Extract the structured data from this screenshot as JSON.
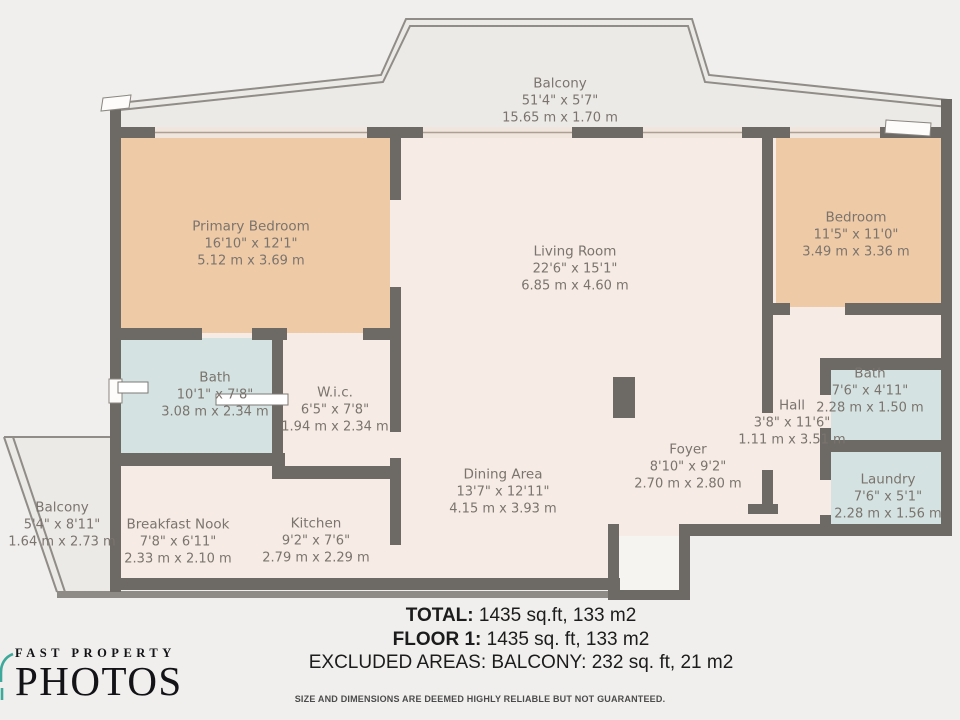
{
  "floorplan": {
    "rooms": [
      {
        "name": "Balcony",
        "imperial": "51'4\" x 5'7\"",
        "metric": "15.65 m x 1.70 m"
      },
      {
        "name": "Primary Bedroom",
        "imperial": "16'10\" x 12'1\"",
        "metric": "5.12 m x 3.69 m"
      },
      {
        "name": "Living Room",
        "imperial": "22'6\" x 15'1\"",
        "metric": "6.85 m x 4.60 m"
      },
      {
        "name": "Bedroom",
        "imperial": "11'5\" x 11'0\"",
        "metric": "3.49 m x 3.36 m"
      },
      {
        "name": "Bath",
        "imperial": "10'1\" x 7'8\"",
        "metric": "3.08 m x 2.34 m"
      },
      {
        "name": "W.i.c.",
        "imperial": "6'5\" x 7'8\"",
        "metric": "1.94 m x 2.34 m"
      },
      {
        "name": "Hall",
        "imperial": "3'8\" x 11'6\"",
        "metric": "1.11 m x 3.51 m"
      },
      {
        "name": "Bath",
        "imperial": "7'6\" x 4'11\"",
        "metric": "2.28 m x 1.50 m"
      },
      {
        "name": "Laundry",
        "imperial": "7'6\" x 5'1\"",
        "metric": "2.28 m x 1.56 m"
      },
      {
        "name": "Foyer",
        "imperial": "8'10\" x 9'2\"",
        "metric": "2.70 m x 2.80 m"
      },
      {
        "name": "Dining Area",
        "imperial": "13'7\" x 12'11\"",
        "metric": "4.15 m x 3.93 m"
      },
      {
        "name": "Kitchen",
        "imperial": "9'2\" x 7'6\"",
        "metric": "2.79 m x 2.29 m"
      },
      {
        "name": "Breakfast Nook",
        "imperial": "7'8\" x 6'11\"",
        "metric": "2.33 m x 2.10 m"
      },
      {
        "name": "Balcony",
        "imperial": "5'4\" x 8'11\"",
        "metric": "1.64 m x 2.73 m"
      }
    ],
    "summary": {
      "total_label": "TOTAL:",
      "total_value": " 1435 sq.ft, 133 m2",
      "floor_label": "FLOOR 1:",
      "floor_value": " 1435 sq. ft, 133 m2",
      "excluded": "EXCLUDED AREAS: BALCONY: 232 sq. ft, 21 m2"
    },
    "disclaimer": "SIZE AND DIMENSIONS ARE DEEMED HIGHLY RELIABLE BUT NOT GUARANTEED.",
    "colors": {
      "wall": "#6d6965",
      "bedroom_fill": "#eecaa6",
      "wet_room_fill": "#d4e3e2",
      "living_fill": "#f6ebe5",
      "background": "#f0efed",
      "label_text": "#7b746e",
      "logo_accent": "#3ea99b"
    }
  },
  "logo": {
    "line1": "FAST PROPERTY",
    "line2": "PHOTOS"
  }
}
